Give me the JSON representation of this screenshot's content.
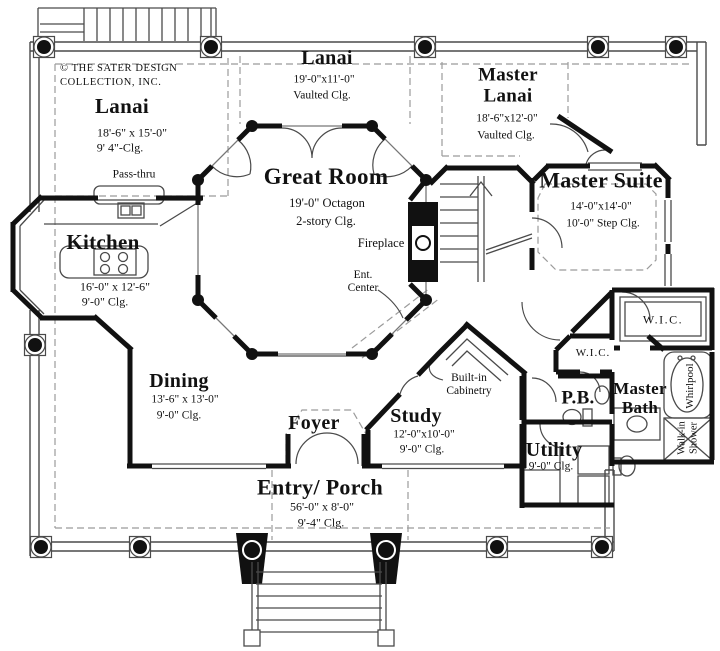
{
  "title": "First floor plan - The Sater Design Collection",
  "copyright": "© THE SATER DESIGN COLLECTION, INC.",
  "rooms": {
    "lanai_left": {
      "name": "Lanai",
      "dims": "18'-6\" x 15'-0\"",
      "clg": "9' 4\"-Clg."
    },
    "lanai_top": {
      "name": "Lanai",
      "dims": "19'-0\"x11'-0\"",
      "clg": "Vaulted Clg."
    },
    "master_lanai": {
      "name": "Master Lanai",
      "dims": "18'-6\"x12'-0\"",
      "clg": "Vaulted Clg."
    },
    "great_room": {
      "name": "Great Room",
      "dims": "19'-0\" Octagon",
      "clg": "2-story Clg."
    },
    "master_suite": {
      "name": "Master Suite",
      "dims": "14'-0\"x14'-0\"",
      "clg": "10'-0\" Step Clg."
    },
    "kitchen": {
      "name": "Kitchen",
      "dims": "16'-0\" x 12'-6\"",
      "clg": "9'-0\" Clg."
    },
    "dining": {
      "name": "Dining",
      "dims": "13'-6\" x 13'-0\"",
      "clg": "9'-0\" Clg."
    },
    "foyer": {
      "name": "Foyer"
    },
    "study": {
      "name": "Study",
      "dims": "12'-0\"x10'-0\"",
      "clg": "9'-0\" Clg."
    },
    "entry_porch": {
      "name": "Entry/ Porch",
      "dims": "56'-0\" x 8'-0\"",
      "clg": "9'-4\" Clg."
    },
    "utility": {
      "name": "Utility",
      "clg": "9'-0\" Clg."
    },
    "powder_bath": {
      "name": "P.B."
    },
    "master_bath": {
      "name": "Master Bath"
    },
    "wic_master": {
      "name": "W.I.C."
    },
    "wic_hall": {
      "name": "W.I.C."
    }
  },
  "features": {
    "pass_thru": "Pass-thru",
    "fireplace": "Fireplace",
    "ent_center": "Ent. Center",
    "built_in_cabinetry": "Built-in Cabinetry",
    "whirlpool": "Whirlpool",
    "walk_in_shower": "Walk-in Shower"
  },
  "colors": {
    "wall": "#111111",
    "line": "#4a4a4a",
    "dashed": "#9b9b9b",
    "background": "#ffffff"
  }
}
